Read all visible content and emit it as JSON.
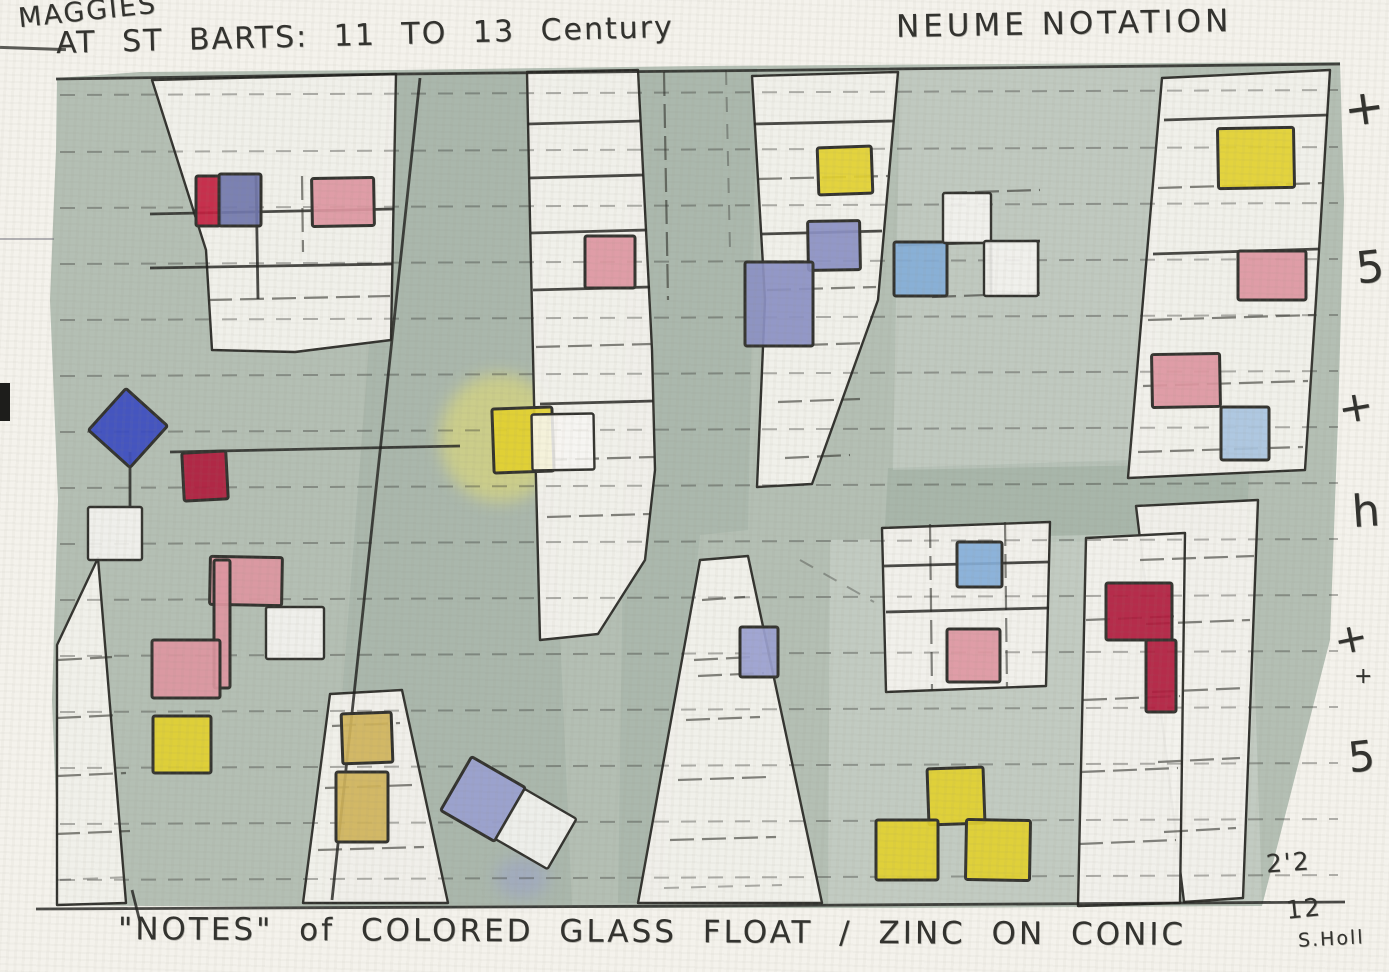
{
  "painting": {
    "title_line1": "MAGGIES",
    "title_line2": "AT ST BARTS: 11 TO 13 Century",
    "title_right": "NEUME NOTATION",
    "caption": "\"NOTES\" of COLORED GLASS  FLOAT / ZINC ON CONIC",
    "dimension_top": "2'2",
    "dimension_bottom": "12",
    "signature": "S.Holl"
  },
  "margin_marks": [
    {
      "glyph": "+",
      "x": 1344,
      "y": 80,
      "size": 48,
      "rot": -8
    },
    {
      "glyph": "5",
      "x": 1356,
      "y": 242,
      "size": 44,
      "rot": -6
    },
    {
      "glyph": "+",
      "x": 1338,
      "y": 382,
      "size": 42,
      "rot": -10
    },
    {
      "glyph": "h",
      "x": 1352,
      "y": 486,
      "size": 44,
      "rot": -4
    },
    {
      "glyph": "+",
      "x": 1334,
      "y": 616,
      "size": 40,
      "rot": -12
    },
    {
      "glyph": "+",
      "x": 1354,
      "y": 664,
      "size": 22,
      "rot": 0
    },
    {
      "glyph": "5",
      "x": 1348,
      "y": 732,
      "size": 42,
      "rot": -6
    }
  ],
  "colors": {
    "paper": "#f4f2ec",
    "wash": "#b4bfb4",
    "washdark": "#8fa396",
    "white": "#f3f1ec",
    "pencil": "#33332f",
    "red": "#c2203f",
    "crimson": "#b01b3d",
    "pink": "#dd96a1",
    "royal": "#3c4cc0",
    "periwinkle": "#8b90c3",
    "lavender": "#9aa0cf",
    "sky": "#84aed8",
    "paleblue": "#a9c4e0",
    "yellow": "#e2d02f",
    "mustard": "#cfb35a",
    "slate": "#7177ad"
  },
  "glass_notes": [
    {
      "x": 196,
      "y": 176,
      "w": 24,
      "h": 50,
      "c": "red",
      "rot": 0
    },
    {
      "x": 219,
      "y": 174,
      "w": 42,
      "h": 52,
      "c": "slate",
      "rot": 0
    },
    {
      "x": 312,
      "y": 178,
      "w": 62,
      "h": 48,
      "c": "pink",
      "rot": -1
    },
    {
      "x": 585,
      "y": 236,
      "w": 50,
      "h": 52,
      "c": "pink",
      "rot": 0
    },
    {
      "x": 100,
      "y": 400,
      "w": 56,
      "h": 56,
      "c": "royal",
      "rot": 42
    },
    {
      "x": 183,
      "y": 452,
      "w": 44,
      "h": 48,
      "c": "crimson",
      "rot": -3
    },
    {
      "x": 210,
      "y": 557,
      "w": 72,
      "h": 48,
      "c": "pink",
      "rot": 1
    },
    {
      "x": 214,
      "y": 560,
      "w": 16,
      "h": 128,
      "c": "pink",
      "rot": 0,
      "bare": true
    },
    {
      "x": 152,
      "y": 640,
      "w": 68,
      "h": 58,
      "c": "pink",
      "rot": 0
    },
    {
      "x": 153,
      "y": 716,
      "w": 58,
      "h": 57,
      "c": "yellow",
      "rot": 0
    },
    {
      "x": 342,
      "y": 713,
      "w": 50,
      "h": 50,
      "c": "mustard",
      "rot": -2
    },
    {
      "x": 336,
      "y": 772,
      "w": 52,
      "h": 70,
      "c": "mustard",
      "rot": 0
    },
    {
      "x": 493,
      "y": 408,
      "w": 60,
      "h": 64,
      "c": "yellow",
      "rot": -2
    },
    {
      "x": 818,
      "y": 147,
      "w": 54,
      "h": 47,
      "c": "yellow",
      "rot": -2
    },
    {
      "x": 808,
      "y": 221,
      "w": 52,
      "h": 49,
      "c": "periwinkle",
      "rot": -1
    },
    {
      "x": 745,
      "y": 262,
      "w": 68,
      "h": 84,
      "c": "periwinkle",
      "rot": 0
    },
    {
      "x": 894,
      "y": 242,
      "w": 53,
      "h": 54,
      "c": "sky",
      "rot": 0
    },
    {
      "x": 740,
      "y": 627,
      "w": 38,
      "h": 50,
      "c": "lavender",
      "rot": 0
    },
    {
      "x": 452,
      "y": 768,
      "w": 62,
      "h": 62,
      "c": "lavender",
      "rot": 30
    },
    {
      "x": 506,
      "y": 800,
      "w": 60,
      "h": 58,
      "c": "white",
      "rot": 30
    },
    {
      "x": 957,
      "y": 542,
      "w": 45,
      "h": 45,
      "c": "sky",
      "rot": 0
    },
    {
      "x": 947,
      "y": 629,
      "w": 53,
      "h": 53,
      "c": "pink",
      "rot": 0
    },
    {
      "x": 1106,
      "y": 583,
      "w": 66,
      "h": 57,
      "c": "crimson",
      "rot": 0
    },
    {
      "x": 1146,
      "y": 640,
      "w": 30,
      "h": 72,
      "c": "crimson",
      "rot": 0
    },
    {
      "x": 928,
      "y": 768,
      "w": 56,
      "h": 56,
      "c": "yellow",
      "rot": -2
    },
    {
      "x": 876,
      "y": 820,
      "w": 62,
      "h": 60,
      "c": "yellow",
      "rot": 0
    },
    {
      "x": 966,
      "y": 820,
      "w": 64,
      "h": 60,
      "c": "yellow",
      "rot": 1
    },
    {
      "x": 1218,
      "y": 128,
      "w": 76,
      "h": 60,
      "c": "yellow",
      "rot": -1
    },
    {
      "x": 1238,
      "y": 251,
      "w": 68,
      "h": 49,
      "c": "pink",
      "rot": 0
    },
    {
      "x": 1152,
      "y": 354,
      "w": 68,
      "h": 53,
      "c": "pink",
      "rot": -1
    },
    {
      "x": 1221,
      "y": 407,
      "w": 48,
      "h": 53,
      "c": "paleblue",
      "rot": 0
    },
    {
      "x": 88,
      "y": 507,
      "w": 54,
      "h": 53,
      "c": "white",
      "rot": 0
    },
    {
      "x": 266,
      "y": 607,
      "w": 58,
      "h": 52,
      "c": "white",
      "rot": 0
    },
    {
      "x": 532,
      "y": 414,
      "w": 62,
      "h": 56,
      "c": "white",
      "rot": -1
    },
    {
      "x": 943,
      "y": 193,
      "w": 48,
      "h": 50,
      "c": "white",
      "rot": 0
    },
    {
      "x": 984,
      "y": 241,
      "w": 54,
      "h": 55,
      "c": "white",
      "rot": 0
    }
  ]
}
